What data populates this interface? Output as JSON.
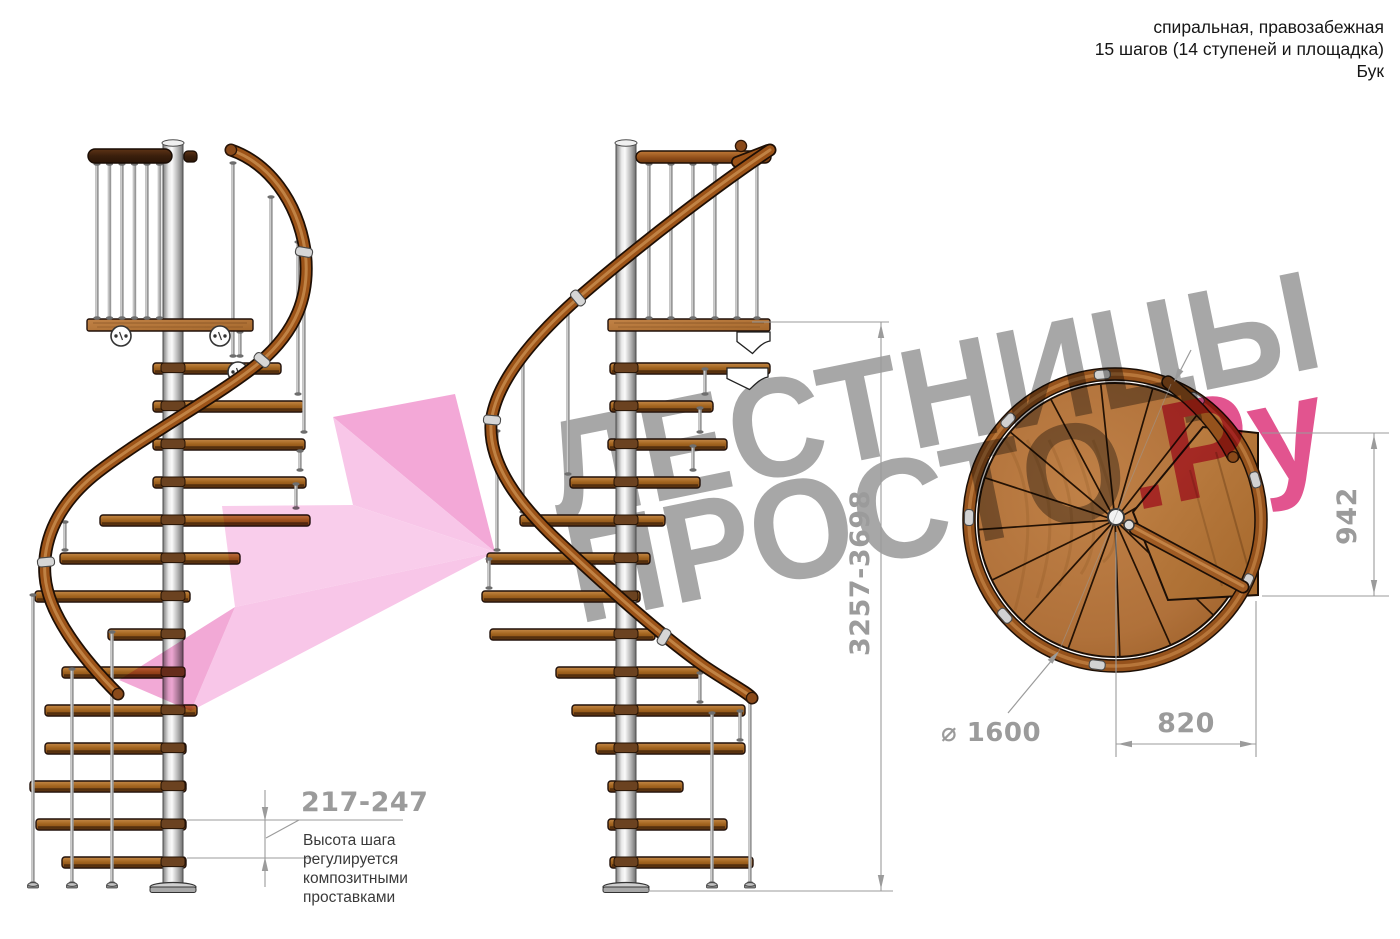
{
  "header": {
    "line1": "спиральная, правозабежная",
    "line2": "15 шагов (14 ступеней и площадка)",
    "line3": "Бук"
  },
  "dimensions": {
    "step_height": "217-247",
    "total_height": "3257-3698",
    "landing_width": "942",
    "landing_depth": "820",
    "diameter": "⌀ 1600"
  },
  "annotation": {
    "step_height_note": "Высота шага регулируется композитными проставками"
  },
  "watermark": {
    "line1": "ЛЕСТНИЦЫ",
    "line2": "ПРОСТО",
    "suffix": ".Ру"
  },
  "drawing": {
    "views": [
      "side view A",
      "side view B",
      "top plan view"
    ],
    "steps_total": 15,
    "treads": 14,
    "has_landing": true
  },
  "colors": {
    "accent_pink": "#e2548f",
    "watermark_gray": "#a7a7a7",
    "dimension_gray": "#9b9b9b",
    "annotation_dark": "#3a3a3a",
    "text_dark": "#161616",
    "wood_mid": "#b0713a",
    "wood_dark": "#7c3e12",
    "wood_light": "#c98a45",
    "pole_gray": "#c9c9c9",
    "arrow_pink_1": "#f8c6e8",
    "arrow_pink_2": "#f3a8d7",
    "arrow_pink_3": "#f9cdeb",
    "arrow_pink_4": "#f2a9d6"
  }
}
